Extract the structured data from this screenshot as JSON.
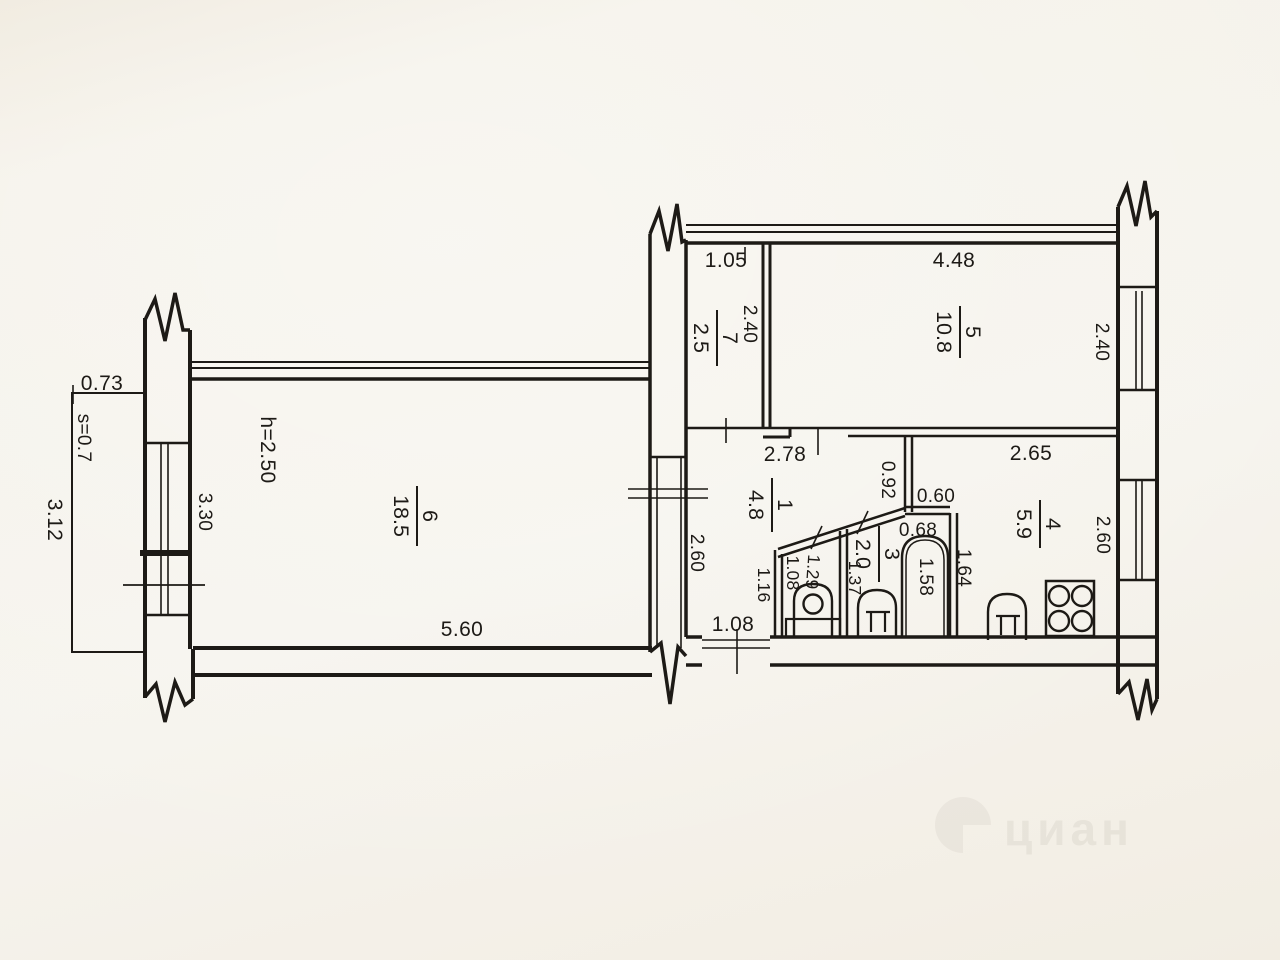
{
  "watermark": {
    "brand": "циан"
  },
  "rooms": [
    {
      "number": "1",
      "area": "4.8"
    },
    {
      "number": "3",
      "area": "2.0"
    },
    {
      "number": "4",
      "area": "5.9"
    },
    {
      "number": "5",
      "area": "10.8"
    },
    {
      "number": "6",
      "area": "18.5"
    },
    {
      "number": "7",
      "area": "2.5"
    }
  ],
  "notes": {
    "ceiling_height": "h=2.50",
    "balcony_area": "s=0.7"
  },
  "dims": {
    "balcony_width": "0.73",
    "balcony_length": "3.12",
    "room6_window": "3.30",
    "room6_width": "5.60",
    "room7_width": "1.05",
    "room7_depth": "2.40",
    "room5_width": "4.48",
    "room5_window": "2.40",
    "room5_bottom": "2.65",
    "hall_width": "2.78",
    "hall_left": "2.60",
    "lobby_depth": "0.92",
    "lobby_width": "0.60",
    "bath_width": "0.68",
    "bath_left": "1.37",
    "tub_length": "1.58",
    "bath_wall": "1.64",
    "wc_outer": "1.16",
    "wc_left": "1.08",
    "wc_right": "1.29",
    "kitchen_window": "2.60",
    "entry_door": "1.08"
  }
}
